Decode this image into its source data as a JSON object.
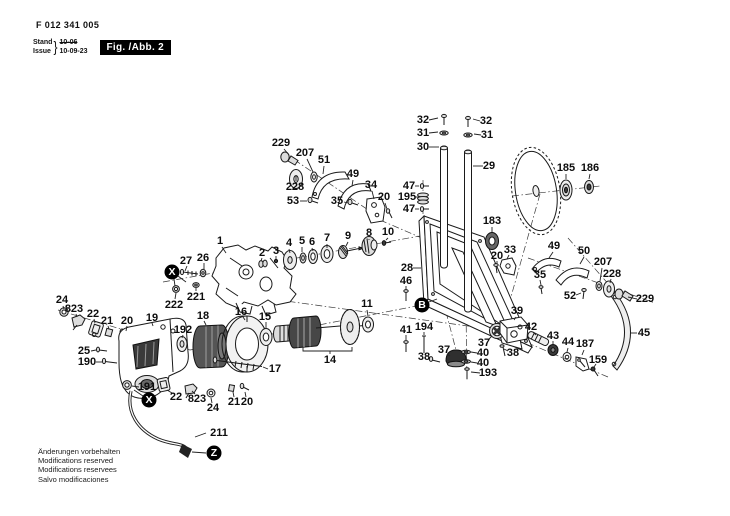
{
  "header": {
    "part_number": "F 012 341 005",
    "stand_label": "Stand",
    "issue_label": "Issue",
    "brace": "}",
    "old_date": "10-06",
    "new_date": "10-09-23",
    "figure_label": "Fig. /Abb. 2"
  },
  "footer": {
    "lines": [
      "Änderungen vorbehalten",
      "Modifications reserved",
      "Modifications reservees",
      "Salvo modificaciones"
    ]
  },
  "markers": [
    {
      "letter": "X",
      "x": 172,
      "y": 272
    },
    {
      "letter": "B",
      "x": 422,
      "y": 305
    },
    {
      "letter": "X",
      "x": 149,
      "y": 400
    },
    {
      "letter": "Z",
      "x": 214,
      "y": 453
    }
  ],
  "labels": [
    {
      "t": "229",
      "x": 281,
      "y": 143,
      "l": [
        284,
        149,
        289,
        155
      ]
    },
    {
      "t": "207",
      "x": 305,
      "y": 153,
      "l": [
        307,
        159,
        313,
        172
      ]
    },
    {
      "t": "51",
      "x": 324,
      "y": 160,
      "l": [
        324,
        166,
        323,
        174
      ]
    },
    {
      "t": "228",
      "x": 295,
      "y": 187,
      "l": [
        296,
        181,
        296,
        176
      ]
    },
    {
      "t": "53",
      "x": 293,
      "y": 201,
      "l": [
        300,
        201,
        307,
        201
      ]
    },
    {
      "t": "49",
      "x": 353,
      "y": 174,
      "l": [
        353,
        180,
        352,
        186
      ]
    },
    {
      "t": "34",
      "x": 371,
      "y": 185,
      "l": [
        372,
        191,
        374,
        199
      ]
    },
    {
      "t": "35",
      "x": 337,
      "y": 201,
      "l": [
        344,
        202,
        348,
        203
      ]
    },
    {
      "t": "20",
      "x": 384,
      "y": 197,
      "l": [
        385,
        203,
        387,
        209
      ]
    },
    {
      "t": "47",
      "x": 409,
      "y": 186,
      "l": [
        415,
        186,
        419,
        186
      ]
    },
    {
      "t": "195",
      "x": 407,
      "y": 197,
      "l": [
        415,
        197,
        419,
        197
      ]
    },
    {
      "t": "47",
      "x": 409,
      "y": 209,
      "l": [
        415,
        209,
        419,
        209
      ]
    },
    {
      "t": "32",
      "x": 423,
      "y": 120,
      "l": [
        429,
        120,
        438,
        118
      ]
    },
    {
      "t": "31",
      "x": 423,
      "y": 133,
      "l": [
        429,
        133,
        438,
        132
      ]
    },
    {
      "t": "30",
      "x": 423,
      "y": 147,
      "l": [
        429,
        147,
        439,
        147
      ]
    },
    {
      "t": "32",
      "x": 486,
      "y": 121,
      "l": [
        480,
        121,
        473,
        119
      ]
    },
    {
      "t": "31",
      "x": 487,
      "y": 135,
      "l": [
        481,
        135,
        474,
        134
      ]
    },
    {
      "t": "29",
      "x": 489,
      "y": 166,
      "l": [
        483,
        166,
        473,
        166
      ]
    },
    {
      "t": "185",
      "x": 566,
      "y": 168,
      "l": [
        566,
        174,
        566,
        179
      ]
    },
    {
      "t": "186",
      "x": 590,
      "y": 168,
      "l": [
        590,
        174,
        589,
        179
      ]
    },
    {
      "t": "183",
      "x": 492,
      "y": 221,
      "l": [
        492,
        227,
        492,
        232
      ]
    },
    {
      "t": "20",
      "x": 497,
      "y": 256,
      "l": [
        497,
        261,
        497,
        264
      ]
    },
    {
      "t": "33",
      "x": 510,
      "y": 250,
      "l": [
        509,
        255,
        507,
        259
      ]
    },
    {
      "t": "28",
      "x": 407,
      "y": 268,
      "l": [
        413,
        268,
        421,
        268
      ]
    },
    {
      "t": "46",
      "x": 406,
      "y": 281,
      "l": [
        406,
        286,
        406,
        290
      ]
    },
    {
      "t": "1",
      "x": 220,
      "y": 241,
      "l": [
        222,
        247,
        226,
        253
      ]
    },
    {
      "t": "27",
      "x": 186,
      "y": 261,
      "l": [
        187,
        266,
        185,
        271
      ]
    },
    {
      "t": "26",
      "x": 203,
      "y": 258,
      "l": [
        204,
        263,
        204,
        269
      ]
    },
    {
      "t": "222",
      "x": 174,
      "y": 305,
      "l": [
        175,
        299,
        176,
        293
      ]
    },
    {
      "t": "221",
      "x": 196,
      "y": 297,
      "l": [
        196,
        291,
        196,
        288
      ]
    },
    {
      "t": "2",
      "x": 262,
      "y": 253,
      "l": [
        262,
        258,
        261,
        261
      ]
    },
    {
      "t": "3",
      "x": 276,
      "y": 251,
      "l": [
        276,
        256,
        276,
        259
      ]
    },
    {
      "t": "4",
      "x": 289,
      "y": 243,
      "l": [
        289,
        249,
        290,
        253
      ]
    },
    {
      "t": "5",
      "x": 302,
      "y": 241,
      "l": [
        302,
        247,
        302,
        252
      ]
    },
    {
      "t": "6",
      "x": 312,
      "y": 242,
      "l": [
        312,
        248,
        313,
        251
      ]
    },
    {
      "t": "7",
      "x": 327,
      "y": 238,
      "l": [
        327,
        244,
        327,
        248
      ]
    },
    {
      "t": "9",
      "x": 348,
      "y": 236,
      "l": [
        348,
        242,
        346,
        246
      ]
    },
    {
      "t": "8",
      "x": 369,
      "y": 233,
      "l": [
        369,
        239,
        369,
        240
      ]
    },
    {
      "t": "10",
      "x": 388,
      "y": 232,
      "l": [
        388,
        238,
        386,
        240
      ]
    },
    {
      "t": "24",
      "x": 62,
      "y": 300,
      "l": [
        63,
        306,
        64,
        309
      ]
    },
    {
      "t": "823",
      "x": 74,
      "y": 309,
      "l": [
        76,
        314,
        77,
        317
      ]
    },
    {
      "t": "22",
      "x": 93,
      "y": 314,
      "l": [
        94,
        319,
        95,
        323
      ]
    },
    {
      "t": "21",
      "x": 107,
      "y": 321,
      "l": [
        108,
        326,
        109,
        329
      ]
    },
    {
      "t": "20",
      "x": 127,
      "y": 321,
      "l": [
        127,
        326,
        126,
        331
      ]
    },
    {
      "t": "19",
      "x": 152,
      "y": 318,
      "l": [
        152,
        323,
        153,
        326
      ]
    },
    {
      "t": "192",
      "x": 183,
      "y": 330,
      "l": [
        183,
        335,
        182,
        338
      ]
    },
    {
      "t": "18",
      "x": 203,
      "y": 316,
      "l": [
        204,
        321,
        206,
        325
      ]
    },
    {
      "t": "16",
      "x": 241,
      "y": 312,
      "l": [
        243,
        317,
        245,
        320
      ]
    },
    {
      "t": "15",
      "x": 265,
      "y": 317,
      "l": [
        266,
        322,
        266,
        328
      ]
    },
    {
      "t": "25",
      "x": 84,
      "y": 351,
      "l": [
        91,
        351,
        96,
        350
      ]
    },
    {
      "t": "190",
      "x": 87,
      "y": 362,
      "l": [
        96,
        362,
        102,
        362
      ]
    },
    {
      "t": "191",
      "x": 147,
      "y": 387,
      "l": [
        139,
        387,
        132,
        386
      ]
    },
    {
      "t": "17",
      "x": 275,
      "y": 369,
      "l": [
        268,
        369,
        263,
        367
      ]
    },
    {
      "t": "14",
      "x": 330,
      "y": 360
    },
    {
      "t": "11",
      "x": 367,
      "y": 304,
      "l": [
        367,
        310,
        368,
        316
      ]
    },
    {
      "t": "22",
      "x": 176,
      "y": 397,
      "l": [
        172,
        393,
        167,
        390
      ]
    },
    {
      "t": "823",
      "x": 197,
      "y": 399,
      "l": [
        195,
        394,
        192,
        391
      ]
    },
    {
      "t": "24",
      "x": 213,
      "y": 408,
      "l": [
        212,
        403,
        211,
        398
      ]
    },
    {
      "t": "21",
      "x": 234,
      "y": 402,
      "l": [
        234,
        397,
        233,
        392
      ]
    },
    {
      "t": "20",
      "x": 247,
      "y": 402,
      "l": [
        246,
        397,
        245,
        392
      ]
    },
    {
      "t": "211",
      "x": 219,
      "y": 433,
      "l": [
        206,
        433,
        195,
        437
      ]
    },
    {
      "t": "41",
      "x": 406,
      "y": 330,
      "l": [
        406,
        335,
        406,
        340
      ]
    },
    {
      "t": "194",
      "x": 424,
      "y": 327,
      "l": [
        424,
        332,
        424,
        335
      ]
    },
    {
      "t": "38",
      "x": 424,
      "y": 357,
      "l": [
        428,
        358,
        430,
        359
      ]
    },
    {
      "t": "37",
      "x": 444,
      "y": 350,
      "l": [
        447,
        354,
        450,
        356
      ]
    },
    {
      "t": "37",
      "x": 484,
      "y": 343,
      "l": [
        488,
        340,
        492,
        336
      ]
    },
    {
      "t": "40",
      "x": 483,
      "y": 353,
      "l": [
        477,
        353,
        471,
        352
      ]
    },
    {
      "t": "40",
      "x": 483,
      "y": 363,
      "l": [
        477,
        363,
        471,
        362
      ]
    },
    {
      "t": "193",
      "x": 488,
      "y": 373,
      "l": [
        480,
        373,
        471,
        372
      ]
    },
    {
      "t": "38",
      "x": 513,
      "y": 353,
      "l": [
        508,
        351,
        504,
        349
      ]
    },
    {
      "t": "39",
      "x": 517,
      "y": 311,
      "l": [
        516,
        317,
        514,
        320
      ]
    },
    {
      "t": "42",
      "x": 531,
      "y": 327,
      "l": [
        533,
        332,
        536,
        335
      ]
    },
    {
      "t": "43",
      "x": 553,
      "y": 336,
      "l": [
        553,
        341,
        553,
        344
      ]
    },
    {
      "t": "44",
      "x": 568,
      "y": 342,
      "l": [
        568,
        348,
        567,
        352
      ]
    },
    {
      "t": "187",
      "x": 585,
      "y": 344,
      "l": [
        584,
        350,
        582,
        355
      ]
    },
    {
      "t": "159",
      "x": 598,
      "y": 360,
      "l": [
        596,
        364,
        594,
        367
      ]
    },
    {
      "t": "45",
      "x": 644,
      "y": 333,
      "l": [
        637,
        333,
        630,
        333
      ]
    },
    {
      "t": "49",
      "x": 554,
      "y": 246,
      "l": [
        553,
        252,
        549,
        258
      ]
    },
    {
      "t": "50",
      "x": 584,
      "y": 251,
      "l": [
        584,
        257,
        580,
        264
      ]
    },
    {
      "t": "207",
      "x": 603,
      "y": 262,
      "l": [
        602,
        268,
        600,
        281
      ]
    },
    {
      "t": "228",
      "x": 612,
      "y": 274,
      "l": [
        611,
        279,
        610,
        283
      ]
    },
    {
      "t": "35",
      "x": 540,
      "y": 275,
      "l": [
        540,
        280,
        541,
        285
      ]
    },
    {
      "t": "52",
      "x": 570,
      "y": 296,
      "l": [
        576,
        295,
        581,
        293
      ]
    },
    {
      "t": "229",
      "x": 645,
      "y": 299,
      "l": [
        637,
        299,
        628,
        297
      ]
    }
  ]
}
